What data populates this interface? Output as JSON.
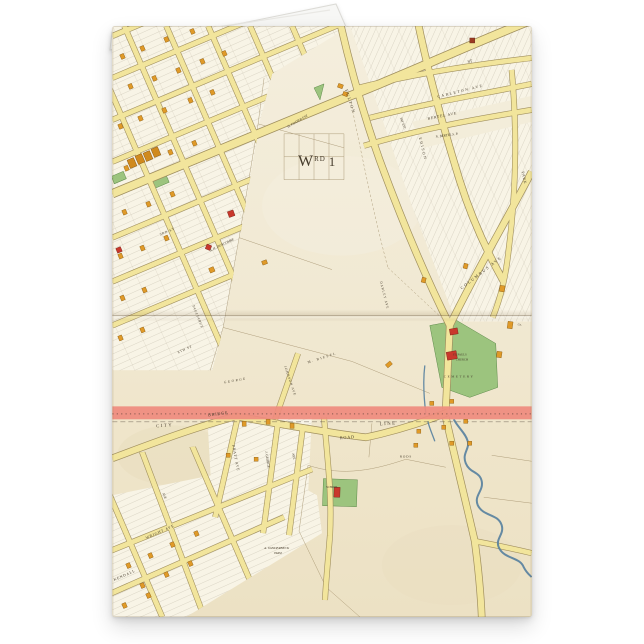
{
  "card": {
    "labels": {
      "ward_w": "W",
      "ward_rd": "RD",
      "ward_num": "1",
      "fulton": "FULTON",
      "edison": "EDISON",
      "columbus": "COLUMBUS AVE",
      "carleton": "CARLETON AVE",
      "bertel": "BERTEL AVE",
      "n_bertel": "N. BERTEL S. P.",
      "st_short": "ST",
      "park": "PARK",
      "third_st": "3RD ST",
      "eighth_st": "8TH ST",
      "foster": "H. FOSTER EST.",
      "fay": "FAY EST.",
      "darley": "DARLEY AVE",
      "biesel": "M. BIESEL",
      "duncombe": "A. H. DUNCOMBE",
      "tagliabue": "TAGLIABUE",
      "george_est": "GEORGE",
      "st_pauls_line1": "ST. PAULS",
      "st_pauls_line2": "CHURCH",
      "cemetery": "CEMETERY",
      "co": "Co.",
      "city": "CITY",
      "line": "LINE",
      "bridge": "BRIDGE",
      "road": "ROAD",
      "johnson": "JOHNSON AVE",
      "pratt": "PRATT AVE",
      "j_george": "J. GEORGE",
      "ave_a": "AVE",
      "ave_b": "AVE",
      "wright": "WRIGHT AVE",
      "kendall": "KENDALL",
      "vanderbeck_1": "A. VANDERBECK",
      "vanderbeck_2": "FARM",
      "rods": "RODS",
      "school": "SCHOOL"
    },
    "colors": {
      "paper": "#f1e9d3",
      "road_fill": "#f2e59c",
      "road_edge": "#a08f5e",
      "building_orange": "#e09a28",
      "building_red": "#c9382c",
      "park_green": "#9cc47e",
      "city_line_pink": "#ef8b7e",
      "river_blue": "#557f9e",
      "ink": "#453b2b",
      "background": "#ffffff",
      "card_back": "#f7f7f5"
    }
  }
}
